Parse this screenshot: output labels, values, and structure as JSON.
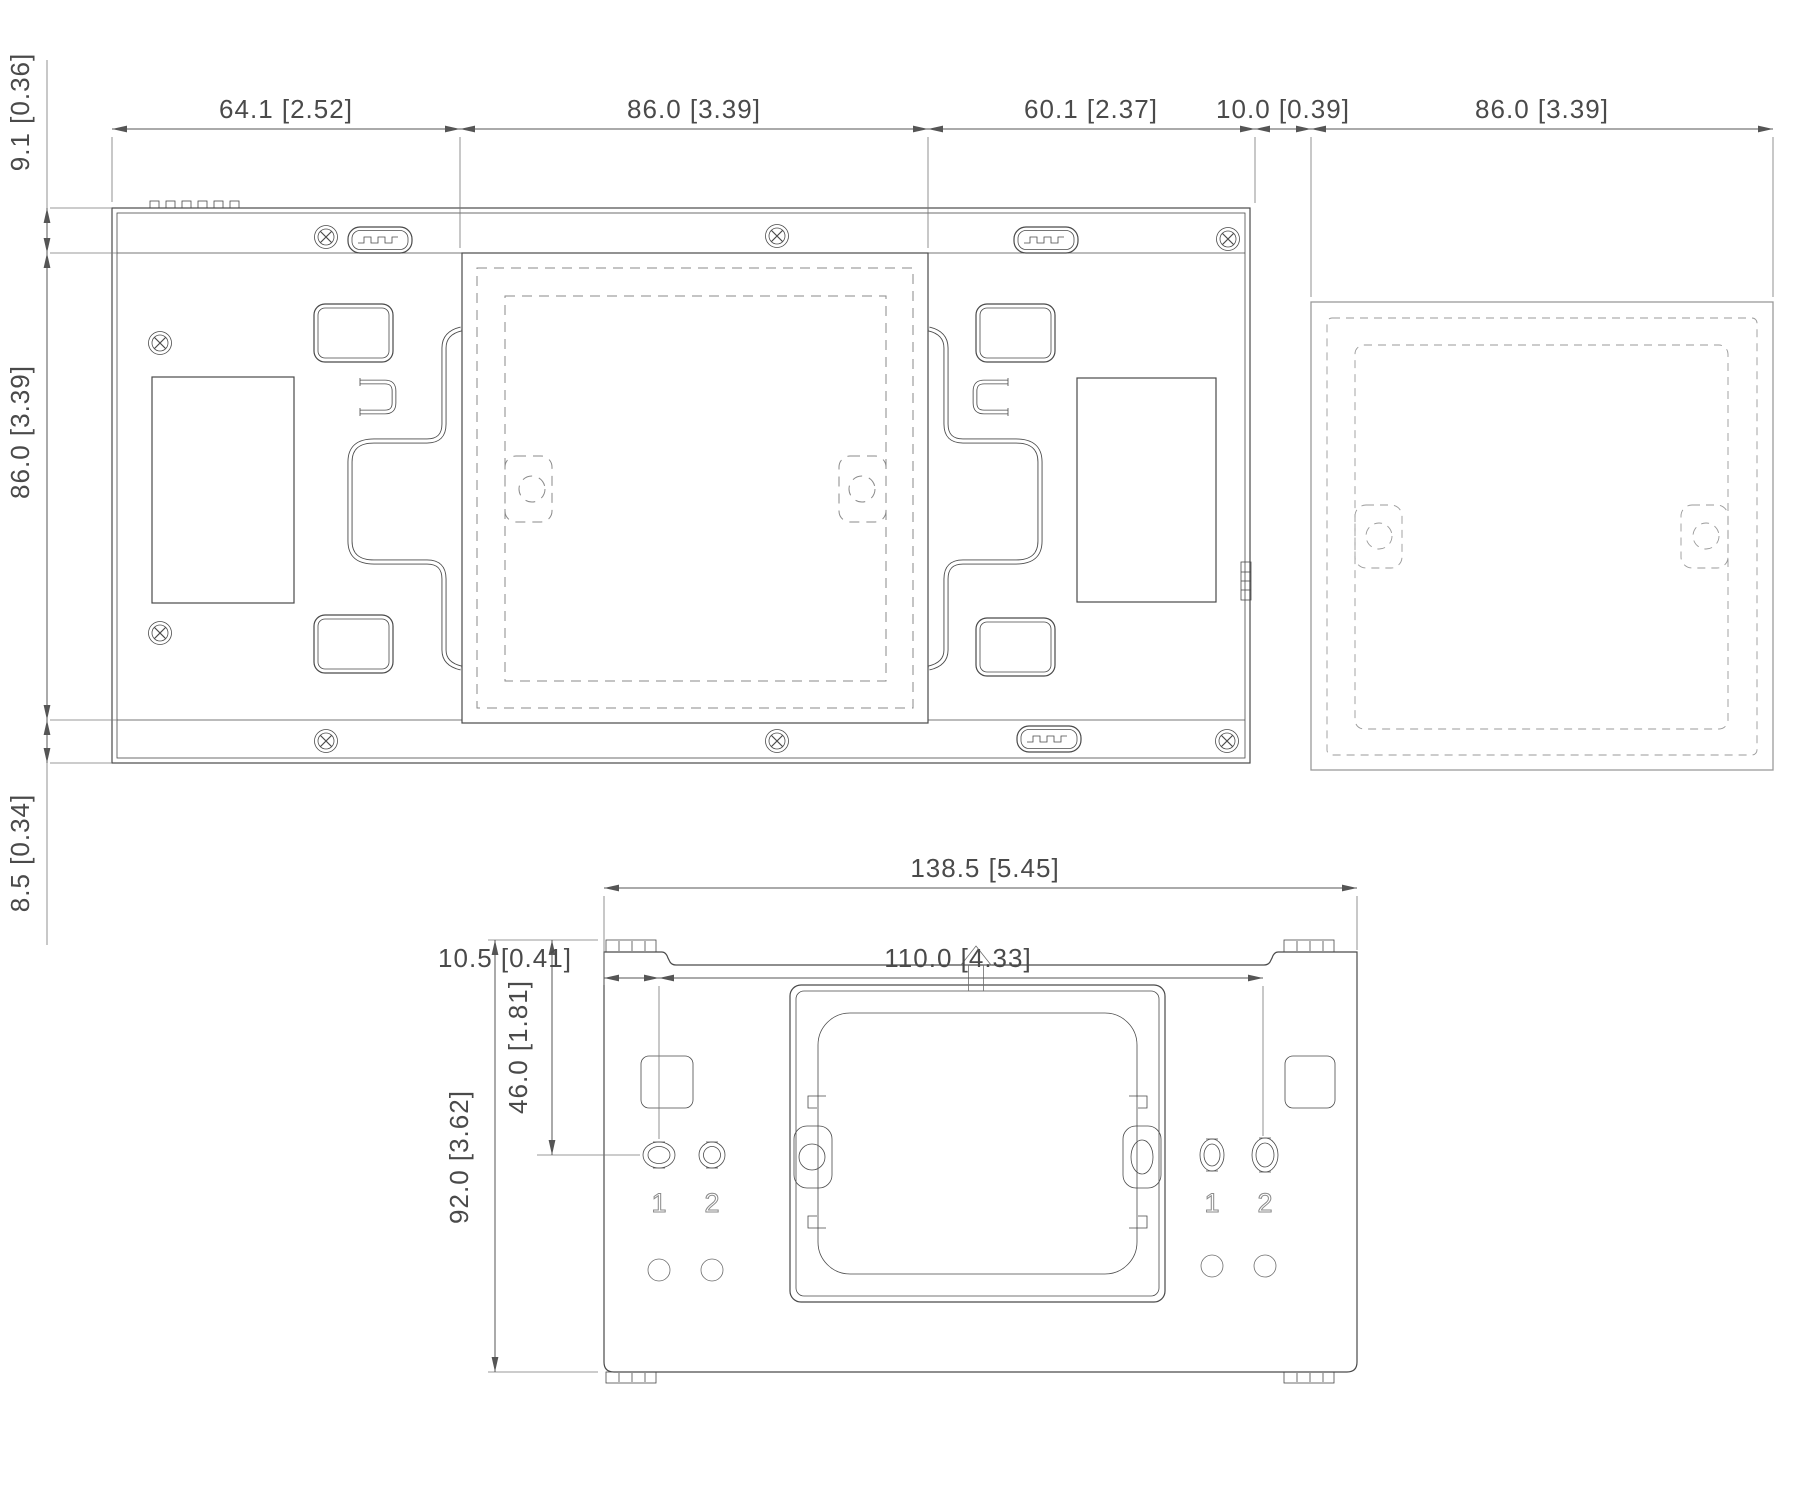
{
  "drawing": {
    "colors": {
      "line": "#4a4a4a",
      "dimension": "#555555",
      "dashed_outline": "#8a8a8a",
      "light_outline": "#9a9a9a"
    },
    "dimensions": {
      "top_view": {
        "horizontal": [
          "64.1  [2.52]",
          "86.0  [3.39]",
          "60.1  [2.37]",
          "10.0  [0.39]",
          "86.0  [3.39]"
        ],
        "vertical": [
          "9.1  [0.36]",
          "86.0  [3.39]",
          "8.5  [0.34]"
        ]
      },
      "bottom_view": {
        "overall_width": "138.5  [5.45]",
        "edge_to_hole": "10.5  [0.41]",
        "hole_spacing": "110.0  [4.33]",
        "top_to_hole": "46.0  [1.81]",
        "overall_height": "92.0  [3.62]",
        "hole_labels": [
          "1",
          "2",
          "1",
          "2"
        ]
      }
    }
  }
}
